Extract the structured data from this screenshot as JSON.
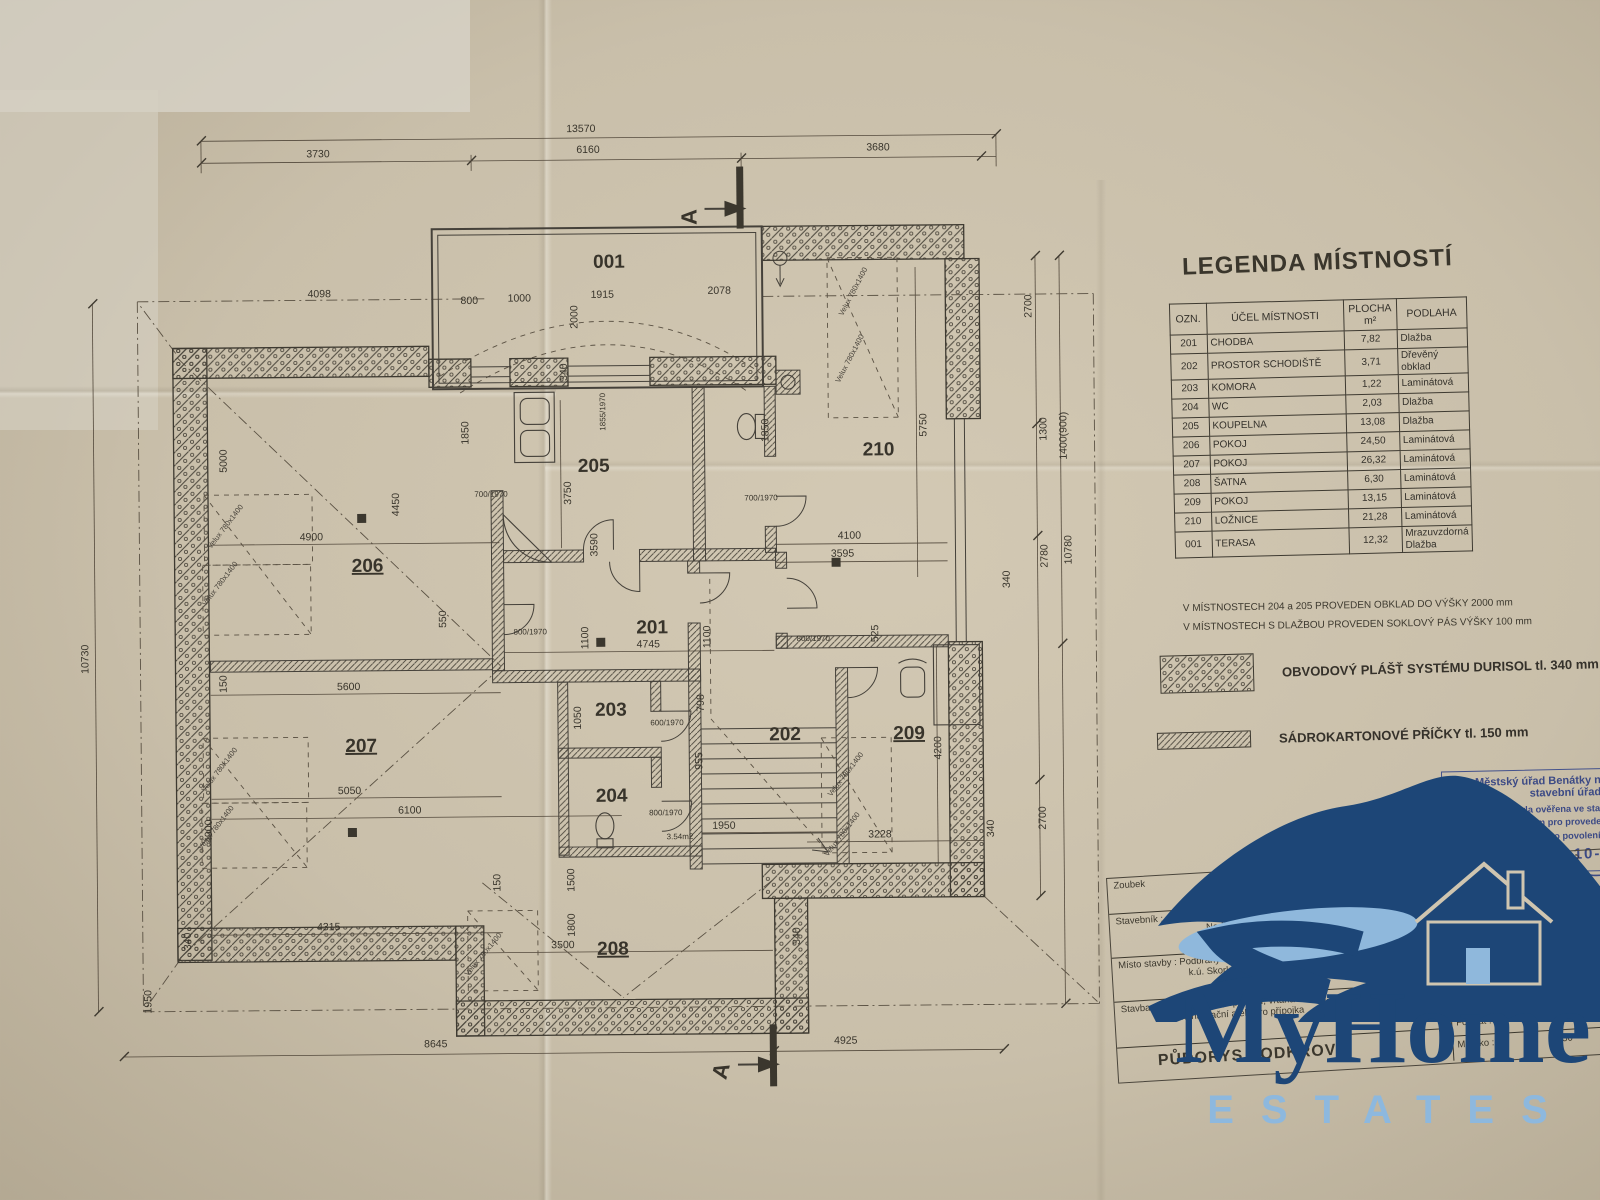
{
  "legend": {
    "title": "LEGENDA MÍSTNOSTÍ",
    "columns": [
      "OZN.",
      "ÚČEL MÍSTNOSTI",
      "PLOCHA\nm²",
      "PODLAHA"
    ],
    "rows": [
      [
        "201",
        "CHODBA",
        "7,82",
        "Dlažba"
      ],
      [
        "202",
        "PROSTOR SCHODIŠTĚ",
        "3,71",
        "Dřevěný obklad"
      ],
      [
        "203",
        "KOMORA",
        "1,22",
        "Laminátová"
      ],
      [
        "204",
        "WC",
        "2,03",
        "Dlažba"
      ],
      [
        "205",
        "KOUPELNA",
        "13,08",
        "Dlažba"
      ],
      [
        "206",
        "POKOJ",
        "24,50",
        "Laminátová"
      ],
      [
        "207",
        "POKOJ",
        "26,32",
        "Laminátová"
      ],
      [
        "208",
        "ŠATNA",
        "6,30",
        "Laminátová"
      ],
      [
        "209",
        "POKOJ",
        "13,15",
        "Laminátová"
      ],
      [
        "210",
        "LOŽNICE",
        "21,28",
        "Laminátová"
      ],
      [
        "001",
        "TERASA",
        "12,32",
        "Mrazuvzdorná Dlažba"
      ]
    ]
  },
  "notes": [
    "V MÍSTNOSTECH 204 a 205 PROVEDEN OBKLAD DO VÝŠKY 2000 mm",
    "V MÍSTNOSTECH S DLAŽBOU PROVEDEN SOKLOVÝ PÁS VÝŠKY 100 mm"
  ],
  "hatch_legend": [
    {
      "label": "OBVODOVÝ PLÁŠŤ SYSTÉMU DURISOL tl. 340 mm"
    },
    {
      "label": "SÁDROKARTONOVÉ PŘÍČKY tl. 150 mm"
    }
  ],
  "stamp": {
    "office1": "Městský úřad Benátky nad Jizerou",
    "office2": "stavební úřad",
    "body1": "Dokumentace byla ověřena ve stavebním",
    "body2": "řízení a je podkladem pro provedení",
    "body3": "stavby podle stavebního povolení,",
    "ze_dne": "ze dne",
    "date": "1 1 -10- 2005"
  },
  "title_block": {
    "row1_value": "Zoubek",
    "stavebnik_label": "Stavebník :",
    "stavebnik_value": "Nad Údolím 226,",
    "misto_label": "Místo stavby :",
    "misto_value1": "Podbrahy",
    "misto_value2": "k.ú. Skorkov",
    "stavba_label": "Stavba:",
    "stavba_value1": "Novostavba RD, oplocení, vrtaná studna, vodovodní,",
    "stavba_value2": "kanalizační a elektro přípojka",
    "drawing_title": "PŮDORYS PODKROVÍ",
    "office_type": "INŽENÝRSKÁ KANCELÁŘ",
    "office_name": "ISA",
    "office_addr1": "Zám",
    "office_addr2": "nad Labem",
    "office_phone": "69119, 326 905589",
    "datum_label": "Datum :",
    "datum_value": "4/2004",
    "format_label": "Formát :",
    "format_value": "A2",
    "meritko_label": "Měřítko :",
    "meritko_value": "1:50"
  },
  "logo": {
    "word": "MyHome",
    "sub": "ESTATES"
  },
  "plan": {
    "section_label": "A",
    "rooms": [
      {
        "t": "001",
        "x": 552,
        "y": 158
      },
      {
        "t": "205",
        "x": 535,
        "y": 362
      },
      {
        "t": "210",
        "x": 820,
        "y": 348
      },
      {
        "t": "206",
        "x": 308,
        "y": 460,
        "u": 1
      },
      {
        "t": "201",
        "x": 592,
        "y": 524
      },
      {
        "t": "203",
        "x": 550,
        "y": 606
      },
      {
        "t": "204",
        "x": 550,
        "y": 692
      },
      {
        "t": "202",
        "x": 724,
        "y": 632
      },
      {
        "t": "207",
        "x": 300,
        "y": 640,
        "u": 1
      },
      {
        "t": "209",
        "x": 848,
        "y": 632,
        "u": 1
      },
      {
        "t": "208",
        "x": 550,
        "y": 845,
        "u": 1
      }
    ],
    "dims": [
      {
        "t": "13570",
        "x": 525,
        "y": 22
      },
      {
        "t": "3730",
        "x": 262,
        "y": 45
      },
      {
        "t": "6160",
        "x": 532,
        "y": 43
      },
      {
        "t": "3680",
        "x": 822,
        "y": 43
      },
      {
        "t": "10730",
        "x": 28,
        "y": 545,
        "r": -90
      },
      {
        "t": "4098",
        "x": 262,
        "y": 185
      },
      {
        "t": "800",
        "x": 412,
        "y": 193
      },
      {
        "t": "1000",
        "x": 462,
        "y": 191
      },
      {
        "t": "1915",
        "x": 545,
        "y": 188
      },
      {
        "t": "2078",
        "x": 662,
        "y": 185
      },
      {
        "t": "2000",
        "x": 520,
        "y": 207,
        "r": -90
      },
      {
        "t": "340",
        "x": 509,
        "y": 262,
        "r": -90
      },
      {
        "t": "1855/1970",
        "x": 547,
        "y": 302,
        "r": -90,
        "s": 1
      },
      {
        "t": "1850",
        "x": 410,
        "y": 322,
        "r": -90
      },
      {
        "t": "1850",
        "x": 710,
        "y": 322,
        "r": -90
      },
      {
        "t": "700/1970",
        "x": 432,
        "y": 386,
        "s": 1
      },
      {
        "t": "700/1970",
        "x": 702,
        "y": 392,
        "s": 1
      },
      {
        "t": "3750",
        "x": 512,
        "y": 383,
        "r": -90
      },
      {
        "t": "5750",
        "x": 868,
        "y": 318,
        "r": -90
      },
      {
        "t": "4100",
        "x": 790,
        "y": 431
      },
      {
        "t": "3595",
        "x": 783,
        "y": 449
      },
      {
        "t": "2700",
        "x": 974,
        "y": 200,
        "r": -90
      },
      {
        "t": "1300",
        "x": 988,
        "y": 323,
        "r": -90
      },
      {
        "t": "1400(900)",
        "x": 1008,
        "y": 330,
        "r": -90
      },
      {
        "t": "2780",
        "x": 988,
        "y": 450,
        "r": -90
      },
      {
        "t": "10780",
        "x": 1012,
        "y": 444,
        "r": -90
      },
      {
        "t": "340",
        "x": 950,
        "y": 473,
        "r": -90
      },
      {
        "t": "2700",
        "x": 984,
        "y": 712,
        "r": -90
      },
      {
        "t": "5000",
        "x": 168,
        "y": 348,
        "r": -90
      },
      {
        "t": "4450",
        "x": 340,
        "y": 393,
        "r": -90
      },
      {
        "t": "4900",
        "x": 252,
        "y": 428
      },
      {
        "t": "550",
        "x": 386,
        "y": 508,
        "r": -90
      },
      {
        "t": "5600",
        "x": 288,
        "y": 578
      },
      {
        "t": "5050",
        "x": 288,
        "y": 682
      },
      {
        "t": "6100",
        "x": 348,
        "y": 702
      },
      {
        "t": "4315",
        "x": 266,
        "y": 818
      },
      {
        "t": "4900",
        "x": 150,
        "y": 718,
        "r": -90
      },
      {
        "t": "150",
        "x": 166,
        "y": 571,
        "r": -90
      },
      {
        "t": "1950",
        "x": 88,
        "y": 888,
        "r": -90
      },
      {
        "t": "340",
        "x": 128,
        "y": 828,
        "r": -90
      },
      {
        "t": "8645",
        "x": 372,
        "y": 936
      },
      {
        "t": "4925",
        "x": 782,
        "y": 936
      },
      {
        "t": "4745",
        "x": 588,
        "y": 538
      },
      {
        "t": "1100",
        "x": 528,
        "y": 528,
        "r": -90
      },
      {
        "t": "1100",
        "x": 650,
        "y": 528,
        "r": -90
      },
      {
        "t": "3590",
        "x": 538,
        "y": 435,
        "r": -90
      },
      {
        "t": "800/1970",
        "x": 470,
        "y": 524,
        "s": 1
      },
      {
        "t": "600/1970",
        "x": 606,
        "y": 616,
        "s": 1
      },
      {
        "t": "800/1970",
        "x": 604,
        "y": 706,
        "s": 1
      },
      {
        "t": "800/1970",
        "x": 753,
        "y": 533,
        "s": 1
      },
      {
        "t": "1050",
        "x": 520,
        "y": 608,
        "r": -90
      },
      {
        "t": "955",
        "x": 641,
        "y": 652,
        "r": -90
      },
      {
        "t": "798",
        "x": 643,
        "y": 594,
        "r": -90
      },
      {
        "t": "1950",
        "x": 662,
        "y": 720
      },
      {
        "t": "3.54m2",
        "x": 618,
        "y": 730,
        "s": 1
      },
      {
        "t": "525",
        "x": 818,
        "y": 526,
        "r": -90
      },
      {
        "t": "4200",
        "x": 880,
        "y": 641,
        "r": -90
      },
      {
        "t": "3228",
        "x": 818,
        "y": 730
      },
      {
        "t": "340",
        "x": 932,
        "y": 722,
        "r": -90
      },
      {
        "t": "3500",
        "x": 500,
        "y": 838
      },
      {
        "t": "1800",
        "x": 512,
        "y": 815,
        "r": -90
      },
      {
        "t": "1500",
        "x": 512,
        "y": 770,
        "r": -90
      },
      {
        "t": "340",
        "x": 737,
        "y": 828,
        "r": -90
      },
      {
        "t": "150",
        "x": 438,
        "y": 772,
        "r": -90
      }
    ],
    "velux": [
      {
        "t": "Velux 780x1400",
        "x": 168,
        "y": 415,
        "r": -52
      },
      {
        "t": "Velux 780x1400",
        "x": 162,
        "y": 472,
        "r": -52
      },
      {
        "t": "Velux 780x1400",
        "x": 160,
        "y": 658,
        "r": -52
      },
      {
        "t": "Velux 780x1400",
        "x": 156,
        "y": 716,
        "r": -52
      },
      {
        "t": "Velux 780x1400",
        "x": 798,
        "y": 185,
        "r": -62
      },
      {
        "t": "Velux 780x1400",
        "x": 794,
        "y": 252,
        "r": -62
      },
      {
        "t": "Velux 780x1400",
        "x": 786,
        "y": 668,
        "r": -52
      },
      {
        "t": "Velux 780x1400",
        "x": 782,
        "y": 728,
        "r": -52
      },
      {
        "t": "Velux 780x1400",
        "x": 422,
        "y": 845,
        "r": -50
      }
    ]
  }
}
